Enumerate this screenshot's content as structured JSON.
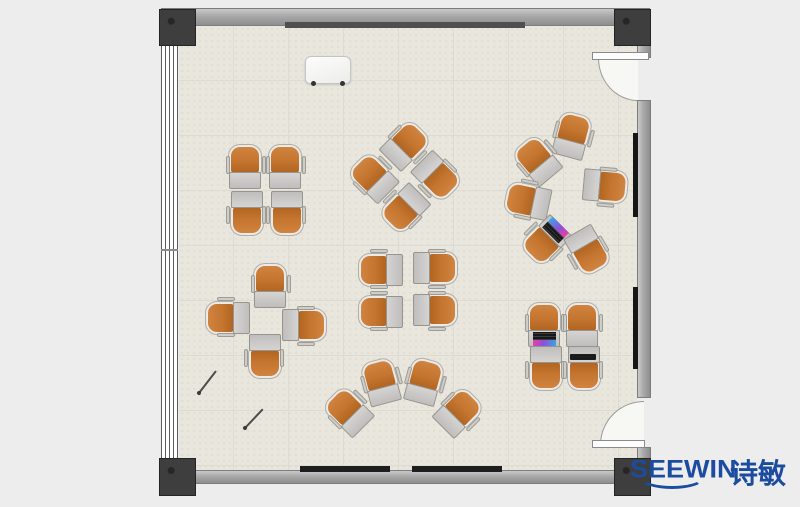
{
  "brand": {
    "name": "SEEWIN",
    "cn": "诗敏",
    "color": "#1b4c9f"
  },
  "scene": {
    "type": "floor-plan",
    "description": "top-view training room with tablet-arm chairs"
  },
  "palette": {
    "background": "#ededed",
    "floor": "#e9e6dd",
    "floor_grid": "#dedbd2",
    "wall": "#a8a8a8",
    "column": "#3e3e3e",
    "chair_orange": "#c4752f",
    "chair_shell": "#eceae6",
    "desk_gray": "#c9c8c6",
    "logo_blue": "#1b4c9f"
  },
  "room": {
    "wall_boards": [
      {
        "name": "top-wall-board",
        "x": 285,
        "y": 22,
        "w": 240,
        "h": 6,
        "color": "#4f4f4f"
      },
      {
        "name": "bottom-wall-screen-left",
        "x": 300,
        "y": 466,
        "w": 90,
        "h": 6,
        "color": "#1e1e1e"
      },
      {
        "name": "bottom-wall-screen-right",
        "x": 412,
        "y": 466,
        "w": 90,
        "h": 6,
        "color": "#1e1e1e"
      },
      {
        "name": "right-wall-panel-top",
        "x": 633,
        "y": 133,
        "w": 5,
        "h": 84,
        "color": "#161616"
      },
      {
        "name": "right-wall-panel-bottom",
        "x": 633,
        "y": 287,
        "w": 5,
        "h": 82,
        "color": "#161616"
      }
    ]
  },
  "furniture": {
    "unit_size": {
      "w": 38,
      "h": 46
    },
    "clusters": [
      {
        "name": "quad-top-left",
        "units": [
          {
            "cx": 246,
            "cy": 167,
            "rot": 0
          },
          {
            "cx": 286,
            "cy": 167,
            "rot": 0
          },
          {
            "cx": 246,
            "cy": 213,
            "rot": 180
          },
          {
            "cx": 286,
            "cy": 213,
            "rot": 180
          }
        ]
      },
      {
        "name": "pinwheel-top-center",
        "units": [
          {
            "cx": 406,
            "cy": 146,
            "rot": 45
          },
          {
            "cx": 436,
            "cy": 177,
            "rot": 135
          },
          {
            "cx": 404,
            "cy": 208,
            "rot": 225
          },
          {
            "cx": 374,
            "cy": 177,
            "rot": 315
          }
        ]
      },
      {
        "name": "circle-right",
        "units": [
          {
            "cx": 573,
            "cy": 136,
            "rot": 15
          },
          {
            "cx": 538,
            "cy": 160,
            "rot": 320
          },
          {
            "cx": 528,
            "cy": 200,
            "rot": 282
          },
          {
            "cx": 605,
            "cy": 187,
            "rot": 95
          },
          {
            "cx": 545,
            "cy": 240,
            "rot": 225,
            "accessory": "laptop"
          },
          {
            "cx": 587,
            "cy": 251,
            "rot": 150
          }
        ]
      },
      {
        "name": "cross-left",
        "units": [
          {
            "cx": 271,
            "cy": 286,
            "rot": 0
          },
          {
            "cx": 228,
            "cy": 317,
            "rot": 270
          },
          {
            "cx": 304,
            "cy": 326,
            "rot": 90
          },
          {
            "cx": 264,
            "cy": 356,
            "rot": 180
          }
        ]
      },
      {
        "name": "quad-center",
        "units": [
          {
            "cx": 381,
            "cy": 269,
            "rot": 270
          },
          {
            "cx": 381,
            "cy": 311,
            "rot": 270
          },
          {
            "cx": 435,
            "cy": 269,
            "rot": 90
          },
          {
            "cx": 435,
            "cy": 311,
            "rot": 90
          }
        ]
      },
      {
        "name": "arc-bottom",
        "units": [
          {
            "cx": 349,
            "cy": 411,
            "rot": 315
          },
          {
            "cx": 382,
            "cy": 382,
            "rot": 345
          },
          {
            "cx": 425,
            "cy": 382,
            "rot": 15
          },
          {
            "cx": 459,
            "cy": 413,
            "rot": 45
          }
        ]
      },
      {
        "name": "quad-bottom-right",
        "units": [
          {
            "cx": 545,
            "cy": 325,
            "rot": 0,
            "accessory": "laptop"
          },
          {
            "cx": 583,
            "cy": 325,
            "rot": 0
          },
          {
            "cx": 545,
            "cy": 368,
            "rot": 180
          },
          {
            "cx": 583,
            "cy": 368,
            "rot": 180,
            "accessory": "tablet"
          }
        ]
      }
    ]
  },
  "floor_items": {
    "whiteboard": {
      "x": 305,
      "y": 56,
      "w": 46,
      "h": 28
    },
    "sticks": [
      {
        "x1": 199,
        "y1": 393,
        "x2": 216,
        "y2": 371
      },
      {
        "x1": 245,
        "y1": 428,
        "x2": 263,
        "y2": 409
      }
    ]
  }
}
